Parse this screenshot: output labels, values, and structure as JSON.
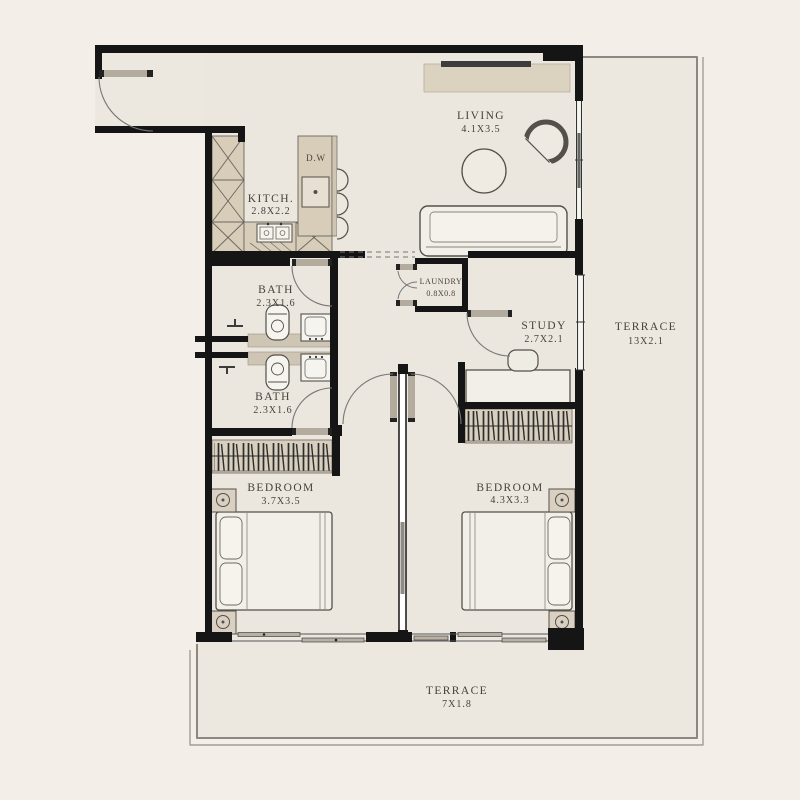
{
  "plan_type": "apartment-floor-plan",
  "rooms": [
    {
      "id": "living",
      "label": "LIVING",
      "dims": "4.1X3.5"
    },
    {
      "id": "kitchen",
      "label": "KITCH.",
      "dims": "2.8X2.2"
    },
    {
      "id": "bath-upper",
      "label": "BATH",
      "dims": "2.3X1.6"
    },
    {
      "id": "laundry",
      "label": "LAUNDRY",
      "dims": "0.8X0.8"
    },
    {
      "id": "study",
      "label": "STUDY",
      "dims": "2.7X2.1"
    },
    {
      "id": "terrace-right",
      "label": "TERRACE",
      "dims": "13X2.1"
    },
    {
      "id": "bath-lower",
      "label": "BATH",
      "dims": "2.3X1.6"
    },
    {
      "id": "bedroom-left",
      "label": "BEDROOM",
      "dims": "3.7X3.5"
    },
    {
      "id": "bedroom-right",
      "label": "BEDROOM",
      "dims": "4.3X3.3"
    },
    {
      "id": "terrace-bottom",
      "label": "TERRACE",
      "dims": "7X1.8"
    }
  ],
  "appliances": {
    "dishwasher": "D.W"
  },
  "colors": {
    "wall": "#151515",
    "cabinet": "#d8cdb9",
    "floor_interior": "#ebe6de",
    "floor_terrace": "#ece7df",
    "outer_background": "#f3efe8",
    "label_text": "#47413a"
  }
}
